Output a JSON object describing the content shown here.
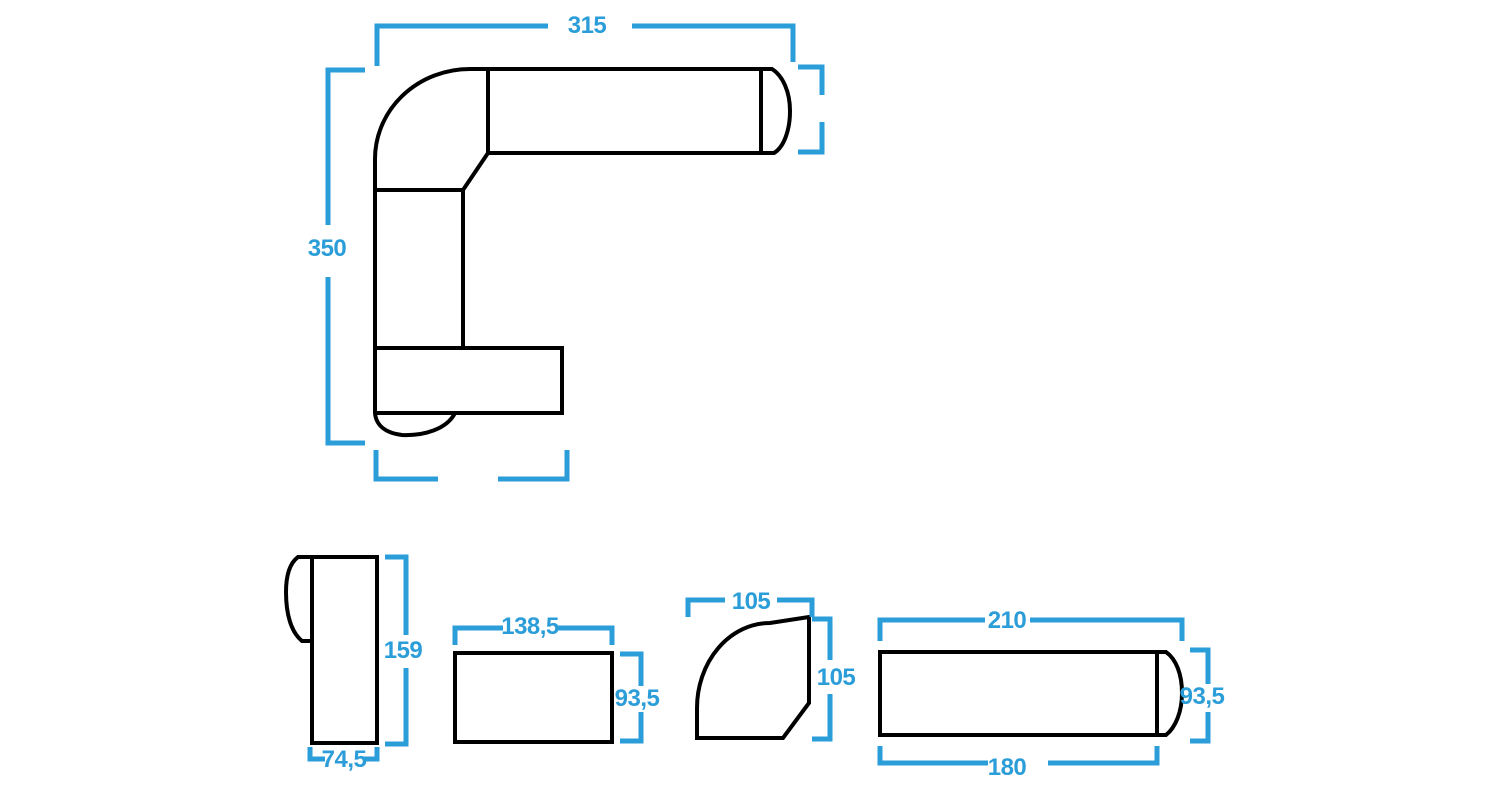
{
  "colors": {
    "dimension_blue": "#2b9dd8",
    "outline_black": "#000000",
    "background": "#ffffff"
  },
  "assembled_view": {
    "name": "L-shaped sectional sofa top view",
    "dim_top": "315",
    "dim_left": "350",
    "dim_right": "",
    "dim_bottom": ""
  },
  "pieces": [
    {
      "name": "chaise module with armrest",
      "dim_height": "159",
      "dim_width": "74,5"
    },
    {
      "name": "seat module",
      "dim_width": "138,5",
      "dim_height": "93,5"
    },
    {
      "name": "corner module",
      "dim_width": "105",
      "dim_height": "105"
    },
    {
      "name": "sofa module with armrest",
      "dim_width_total": "210",
      "dim_height": "93,5",
      "dim_width_seat": "180"
    }
  ]
}
